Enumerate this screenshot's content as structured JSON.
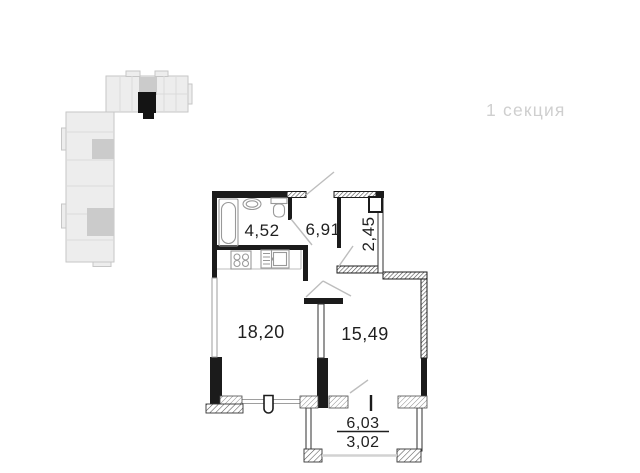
{
  "section_label": "1 секция",
  "rooms": [
    {
      "name": "bathroom",
      "area": "4,52"
    },
    {
      "name": "hallway",
      "area": "6,91"
    },
    {
      "name": "wardrobe",
      "area": "2,45"
    },
    {
      "name": "living-room-kitchen",
      "area": "18,20"
    },
    {
      "name": "bedroom",
      "area": "15,49"
    }
  ],
  "balcony": {
    "area_total": "6,03",
    "area_counted": "3,02"
  },
  "fixtures": [
    "bathtub",
    "bathroom-sink",
    "toilet",
    "stove",
    "kitchen-sink"
  ],
  "minimap": {
    "building_fill": "#ededed",
    "building_stroke": "#c6c6c6",
    "core_fill": "#cbcbcb",
    "highlighted_unit_color": "#141414"
  },
  "colors": {
    "wall": "#1b1b1b",
    "fixture_line": "#999999",
    "door_swing": "#bdbdbd",
    "window_line": "#9e9e9e",
    "glazing_line": "#d2d2d2",
    "label_text": "#1f1f1f",
    "section_label_text": "#cfcfcf",
    "background": "#ffffff"
  }
}
